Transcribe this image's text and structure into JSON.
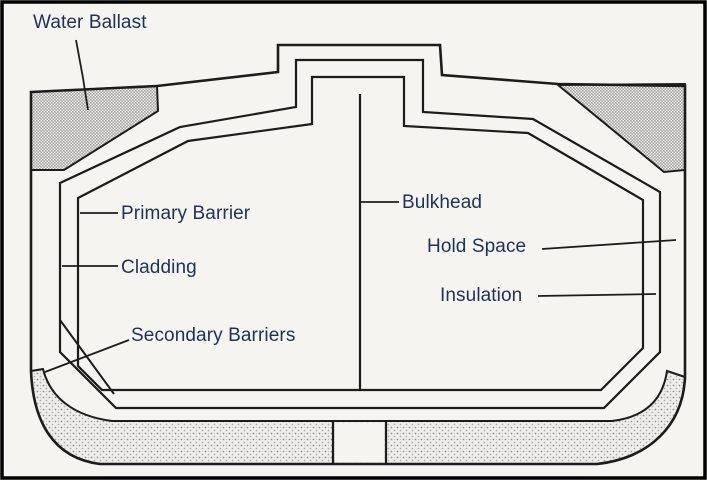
{
  "diagram": {
    "labels": {
      "water_ballast": "Water Ballast",
      "primary_barrier": "Primary Barrier",
      "cladding": "Cladding",
      "secondary_barriers": "Secondary Barriers",
      "bulkhead": "Bulkhead",
      "hold_space": "Hold Space",
      "insulation": "Insulation"
    },
    "colors": {
      "background": "#f5f4f1",
      "line": "#1c1c1c",
      "label_text": "#1e3157",
      "hatch_dense": "#a2a2a2",
      "hatch_stipple": "#8f8f8f",
      "frame": "#000000"
    }
  }
}
